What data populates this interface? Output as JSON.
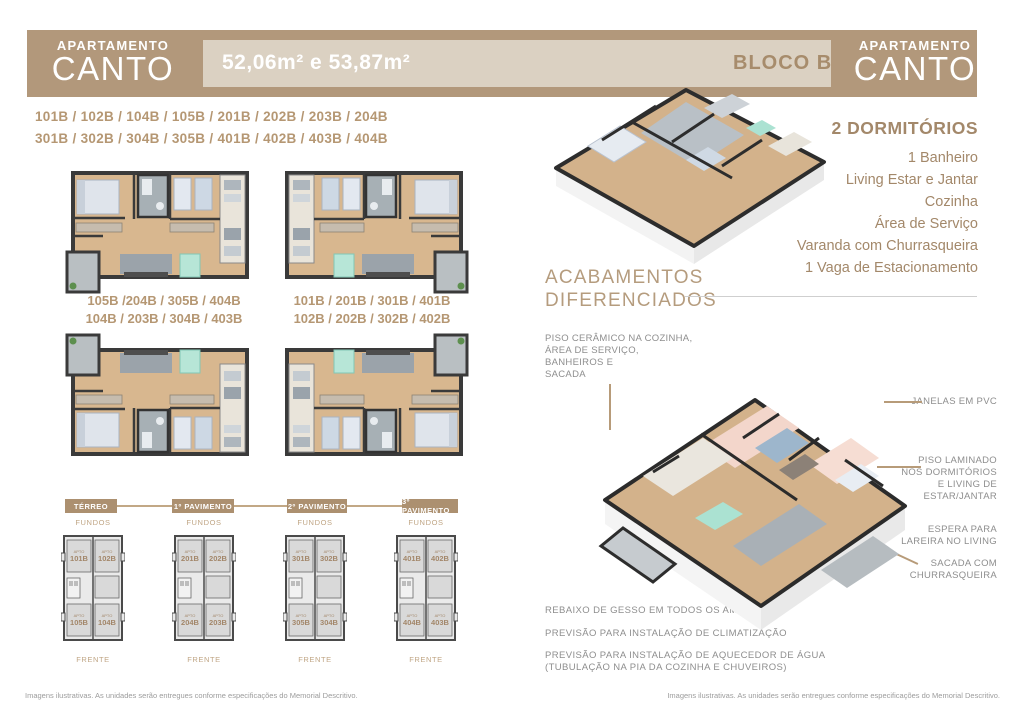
{
  "header": {
    "left_banner": {
      "top": "APARTAMENTO",
      "title": "CANTO"
    },
    "right_banner": {
      "top": "APARTAMENTO",
      "title": "CANTO"
    },
    "area_label": "52,06m² e 53,87m²",
    "bloco_label": "BLOCO B"
  },
  "units_line1": "101B / 102B / 104B / 105B / 201B / 202B / 203B / 204B",
  "units_line2": "301B / 302B / 304B / 305B / 401B / 402B / 403B / 404B",
  "plan_labels": {
    "left_top": "105B /204B / 305B / 404B",
    "left_bottom": "104B / 203B / 304B / 403B",
    "right_top": "101B / 201B / 301B / 401B",
    "right_bottom": "102B / 202B / 302B / 402B"
  },
  "details": {
    "title": "2 DORMITÓRIOS",
    "items": [
      "1 Banheiro",
      "Living Estar e Jantar",
      "Cozinha",
      "Área de Serviço",
      "Varanda com Churrasqueira",
      "1 Vaga de Estacionamento"
    ]
  },
  "acabamentos": {
    "line1": "ACABAMENTOS",
    "line2": "DIFERENCIADOS"
  },
  "callouts": {
    "piso_ceramico_lines": [
      "PISO CERÂMICO NA COZINHA,",
      "ÁREA DE SERVIÇO,",
      "BANHEIROS E",
      "SACADA"
    ],
    "janelas": "JANELAS EM PVC",
    "piso_laminado_lines": [
      "PISO LAMINADO",
      "NOS DORMITÓRIOS",
      "E LIVING DE",
      "ESTAR/JANTAR"
    ],
    "espera_lines": [
      "ESPERA PARA",
      "LAREIRA NO LIVING"
    ],
    "sacada_lines": [
      "SACADA COM",
      "CHURRASQUEIRA"
    ]
  },
  "features": [
    "REBAIXO DE GESSO EM TODOS OS AMBIENTES",
    "PREVISÃO PARA INSTALAÇÃO DE CLIMATIZAÇÃO",
    "PREVISÃO PARA INSTALAÇÃO DE AQUECEDOR DE ÁGUA",
    "(TUBULAÇÃO NA PIA DA COZINHA E CHUVEIROS)"
  ],
  "apto_label": "APTO",
  "fundos_label": "FUNDOS",
  "frente_label": "FRENTE",
  "pavimentos": [
    {
      "label": "TÉRREO",
      "units": {
        "tl": "101B",
        "tr": "102B",
        "bl": "105B",
        "br": "104B"
      }
    },
    {
      "label": "1º PAVIMENTO",
      "units": {
        "tl": "201B",
        "tr": "202B",
        "bl": "204B",
        "br": "203B"
      }
    },
    {
      "label": "2º PAVIMENTO",
      "units": {
        "tl": "301B",
        "tr": "302B",
        "bl": "305B",
        "br": "304B"
      }
    },
    {
      "label": "3º PAVIMENTO",
      "units": {
        "tl": "401B",
        "tr": "402B",
        "bl": "404B",
        "br": "403B"
      }
    }
  ],
  "footer_left": "Imagens ilustrativas. As unidades serão entregues conforme especificações do Memorial Descritivo.",
  "footer_right": "Imagens ilustrativas. As unidades serão entregues conforme especificações do Memorial Descritivo.",
  "colors": {
    "brown_band": "#b2987b",
    "light_tan": "#dbd1c2",
    "text_brown": "#b59773",
    "leader_tan": "#b79b79",
    "gray_text": "#8e8e8e"
  }
}
